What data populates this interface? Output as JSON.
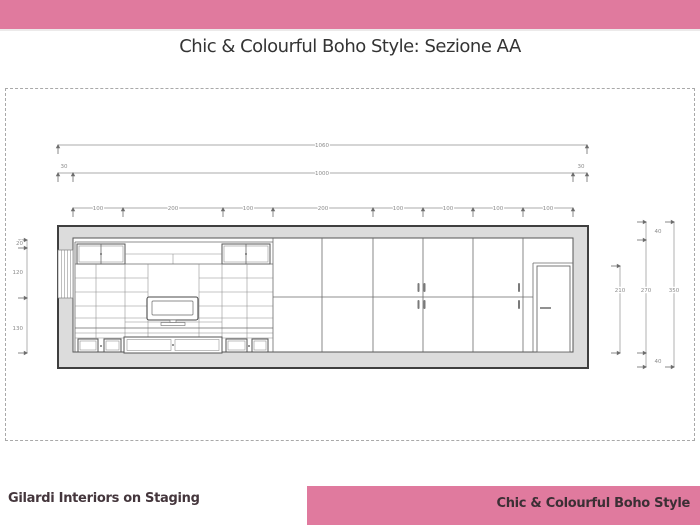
{
  "page": {
    "accent_pink": "#e07a9e",
    "background": "#ffffff"
  },
  "header": {
    "title": "Chic & Colourful Boho Style: Sezione AA"
  },
  "footer": {
    "left_text": "Gilardi Interiors on Staging",
    "right_text": "Chic & Colourful Boho Style"
  },
  "drawing": {
    "name": "Sezione AA - wall section with media unit, wardrobe and door",
    "dims_top": {
      "total": "1060",
      "wall_left": "30",
      "interior": "1000",
      "wall_right": "30",
      "segments": [
        "100",
        "200",
        "100",
        "200",
        "100",
        "100",
        "100",
        "100"
      ]
    },
    "dims_left": {
      "top": "20",
      "window": "120",
      "sill": "130"
    },
    "dims_right": {
      "door_height": "210",
      "ceiling": "40",
      "interior_height": "270",
      "floor": "40",
      "total": "350"
    }
  }
}
